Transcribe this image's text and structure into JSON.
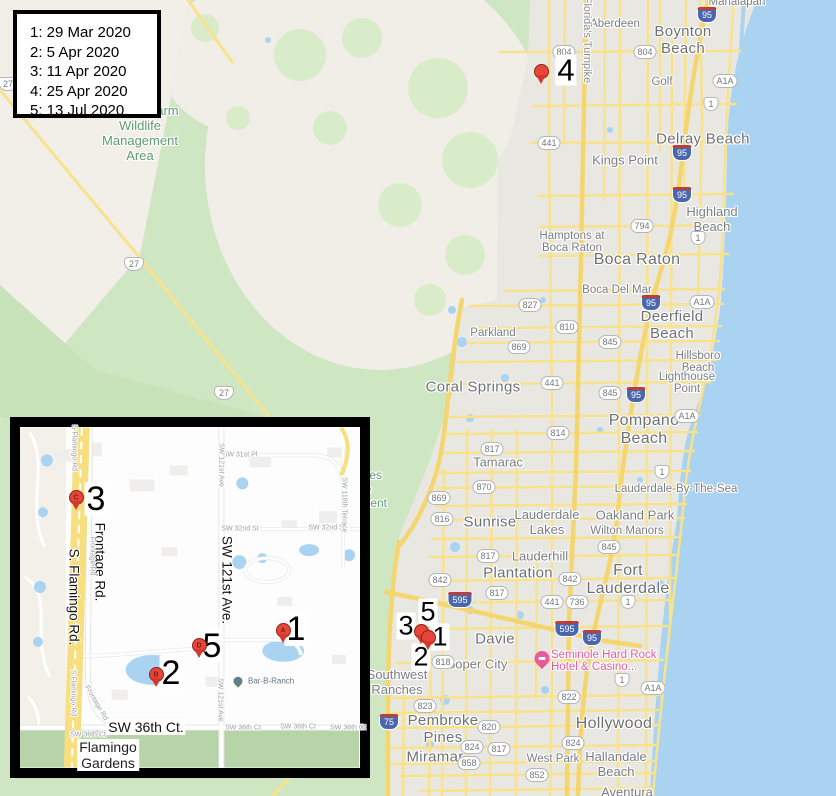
{
  "legend": {
    "entries": [
      "1: 29 Mar 2020",
      "2: 5 Apr 2020",
      "3: 11 Apr 2020",
      "4: 25 Apr 2020",
      "5: 13 Jul 2020"
    ]
  },
  "colors": {
    "water": "#a9d3f1",
    "urban": "#e9e7e2",
    "farmland": "#f1efe8",
    "conservation_green": "#cfe6c2",
    "road_yellow": "#f8e28c",
    "marker_red": "#e6453a",
    "poi_pink": "#e85a9e",
    "label_green": "#5e9b6e"
  },
  "main_map": {
    "labels": [
      {
        "t": "Boynton\nBeach",
        "x": 683,
        "y": 40,
        "c": "city"
      },
      {
        "t": "Delray Beach",
        "x": 703,
        "y": 139,
        "c": "city"
      },
      {
        "t": "Boca Raton",
        "x": 637,
        "y": 260,
        "c": "city",
        "s": 16
      },
      {
        "t": "Deerfield\nBeach",
        "x": 672,
        "y": 325,
        "c": "city"
      },
      {
        "t": "Pompano\nBeach",
        "x": 644,
        "y": 430,
        "c": "city",
        "s": 16
      },
      {
        "t": "Fort\nLauderdale",
        "x": 628,
        "y": 580,
        "c": "city",
        "s": 16
      },
      {
        "t": "Hollywood",
        "x": 614,
        "y": 724,
        "c": "city",
        "s": 16
      },
      {
        "t": "Coral Springs",
        "x": 473,
        "y": 387,
        "c": "city"
      },
      {
        "t": "Sunrise",
        "x": 490,
        "y": 522,
        "c": "city"
      },
      {
        "t": "Plantation",
        "x": 518,
        "y": 573,
        "c": "city"
      },
      {
        "t": "Davie",
        "x": 495,
        "y": 639,
        "c": "city"
      },
      {
        "t": "Tamarac",
        "x": 498,
        "y": 462,
        "c": "town",
        "s": 13
      },
      {
        "t": "Miramar",
        "x": 435,
        "y": 757,
        "c": "city"
      },
      {
        "t": "Pembroke\nPines",
        "x": 443,
        "y": 729,
        "c": "city"
      },
      {
        "t": "Hallandale\nBeach",
        "x": 616,
        "y": 764,
        "c": "town",
        "s": 13
      },
      {
        "t": "Aberdeen",
        "x": 615,
        "y": 24,
        "c": "town"
      },
      {
        "t": "Kings Point",
        "x": 625,
        "y": 160,
        "c": "town",
        "s": 13
      },
      {
        "t": "Golf",
        "x": 662,
        "y": 82,
        "c": "town"
      },
      {
        "t": "Highland\nBeach",
        "x": 712,
        "y": 219,
        "c": "town",
        "s": 13
      },
      {
        "t": "Hamptons at\nBoca Raton",
        "x": 572,
        "y": 242,
        "c": "town"
      },
      {
        "t": "Boca Del Mar",
        "x": 617,
        "y": 290,
        "c": "town"
      },
      {
        "t": "Parkland",
        "x": 493,
        "y": 333,
        "c": "town"
      },
      {
        "t": "Hillsboro\nBeach",
        "x": 698,
        "y": 362,
        "c": "town"
      },
      {
        "t": "Lighthouse\nPoint",
        "x": 687,
        "y": 383,
        "c": "town"
      },
      {
        "t": "Lauderdale-By-The-Sea",
        "x": 676,
        "y": 489,
        "c": "town"
      },
      {
        "t": "Oakland Park",
        "x": 635,
        "y": 515,
        "c": "town",
        "s": 13
      },
      {
        "t": "Wilton Manors",
        "x": 627,
        "y": 531,
        "c": "town"
      },
      {
        "t": "Lauderdale\nLakes",
        "x": 547,
        "y": 522,
        "c": "town",
        "s": 13
      },
      {
        "t": "Lauderhill",
        "x": 540,
        "y": 556,
        "c": "town",
        "s": 13
      },
      {
        "t": "Cooper City",
        "x": 473,
        "y": 664,
        "c": "town",
        "s": 13
      },
      {
        "t": "Southwest\nRanches",
        "x": 397,
        "y": 682,
        "c": "town",
        "s": 13
      },
      {
        "t": "West Park",
        "x": 553,
        "y": 759,
        "c": "town"
      },
      {
        "t": "Aventura",
        "x": 627,
        "y": 792,
        "c": "town",
        "s": 13
      },
      {
        "t": "Manalapan",
        "x": 737,
        "y": 2,
        "c": "town"
      },
      {
        "t": "Browns Farm\nWildlife\nManagement\nArea",
        "x": 140,
        "y": 133,
        "c": "green",
        "s": 13
      },
      {
        "t": "Everglades\nWildlife\nManagement\nArea...",
        "x": 352,
        "y": 496,
        "c": "green"
      },
      {
        "t": "Florida's Turnpike",
        "x": 587,
        "y": 40,
        "c": "vroad",
        "rot": 90
      }
    ],
    "shields": [
      {
        "k": "i",
        "t": "95",
        "x": 707,
        "y": 15
      },
      {
        "k": "s",
        "t": "804",
        "x": 564,
        "y": 52
      },
      {
        "k": "s",
        "t": "804",
        "x": 645,
        "y": 52
      },
      {
        "k": "s",
        "t": "A1A",
        "x": 725,
        "y": 81
      },
      {
        "k": "u",
        "t": "1",
        "x": 711,
        "y": 104
      },
      {
        "k": "s",
        "t": "441",
        "x": 549,
        "y": 143
      },
      {
        "k": "i",
        "t": "95",
        "x": 682,
        "y": 153
      },
      {
        "k": "i",
        "t": "95",
        "x": 682,
        "y": 195
      },
      {
        "k": "s",
        "t": "794",
        "x": 642,
        "y": 226
      },
      {
        "k": "u",
        "t": "1",
        "x": 698,
        "y": 238
      },
      {
        "k": "u",
        "t": "27",
        "x": 8,
        "y": 84
      },
      {
        "k": "u",
        "t": "27",
        "x": 134,
        "y": 264
      },
      {
        "k": "s",
        "t": "A1A",
        "x": 702,
        "y": 302
      },
      {
        "k": "s",
        "t": "827",
        "x": 530,
        "y": 305
      },
      {
        "k": "i",
        "t": "95",
        "x": 651,
        "y": 303
      },
      {
        "k": "s",
        "t": "810",
        "x": 567,
        "y": 327
      },
      {
        "k": "s",
        "t": "845",
        "x": 610,
        "y": 342
      },
      {
        "k": "s",
        "t": "869",
        "x": 519,
        "y": 347
      },
      {
        "k": "s",
        "t": "441",
        "x": 552,
        "y": 383
      },
      {
        "k": "s",
        "t": "845",
        "x": 610,
        "y": 393
      },
      {
        "k": "i",
        "t": "95",
        "x": 636,
        "y": 395
      },
      {
        "k": "u",
        "t": "27",
        "x": 224,
        "y": 393
      },
      {
        "k": "s",
        "t": "A1A",
        "x": 687,
        "y": 416
      },
      {
        "k": "s",
        "t": "814",
        "x": 558,
        "y": 433
      },
      {
        "k": "s",
        "t": "817",
        "x": 492,
        "y": 449
      },
      {
        "k": "u",
        "t": "1",
        "x": 662,
        "y": 472
      },
      {
        "k": "s",
        "t": "870",
        "x": 484,
        "y": 487
      },
      {
        "k": "s",
        "t": "869",
        "x": 439,
        "y": 498
      },
      {
        "k": "s",
        "t": "816",
        "x": 442,
        "y": 519
      },
      {
        "k": "s",
        "t": "845",
        "x": 609,
        "y": 547
      },
      {
        "k": "s",
        "t": "817",
        "x": 488,
        "y": 556
      },
      {
        "k": "s",
        "t": "842",
        "x": 440,
        "y": 580
      },
      {
        "k": "s",
        "t": "842",
        "x": 570,
        "y": 579
      },
      {
        "k": "s",
        "t": "817",
        "x": 497,
        "y": 593
      },
      {
        "k": "i",
        "t": "595",
        "x": 460,
        "y": 600
      },
      {
        "k": "s",
        "t": "441",
        "x": 552,
        "y": 602
      },
      {
        "k": "s",
        "t": "736",
        "x": 577,
        "y": 602
      },
      {
        "k": "u",
        "t": "1",
        "x": 628,
        "y": 602
      },
      {
        "k": "i",
        "t": "595",
        "x": 567,
        "y": 629
      },
      {
        "k": "i",
        "t": "95",
        "x": 592,
        "y": 638
      },
      {
        "k": "s",
        "t": "818",
        "x": 443,
        "y": 662
      },
      {
        "k": "u",
        "t": "1",
        "x": 622,
        "y": 680
      },
      {
        "k": "s",
        "t": "A1A",
        "x": 653,
        "y": 688
      },
      {
        "k": "s",
        "t": "822",
        "x": 569,
        "y": 697
      },
      {
        "k": "s",
        "t": "823",
        "x": 425,
        "y": 706
      },
      {
        "k": "i",
        "t": "75",
        "x": 389,
        "y": 722
      },
      {
        "k": "s",
        "t": "820",
        "x": 489,
        "y": 727
      },
      {
        "k": "s",
        "t": "824",
        "x": 472,
        "y": 747
      },
      {
        "k": "s",
        "t": "824",
        "x": 573,
        "y": 743
      },
      {
        "k": "s",
        "t": "817",
        "x": 499,
        "y": 749
      },
      {
        "k": "s",
        "t": "858",
        "x": 469,
        "y": 763
      },
      {
        "k": "s",
        "t": "852",
        "x": 537,
        "y": 775
      }
    ],
    "markers": {
      "numbers": [
        {
          "t": "4",
          "x": 566,
          "y": 70,
          "fs": 31
        },
        {
          "t": "3",
          "x": 406,
          "y": 626,
          "fs": 27
        },
        {
          "t": "5",
          "x": 428,
          "y": 612,
          "fs": 27
        },
        {
          "t": "1",
          "x": 440,
          "y": 637,
          "fs": 27
        },
        {
          "t": "2",
          "x": 421,
          "y": 657,
          "fs": 27
        }
      ],
      "pins": [
        {
          "x": 541,
          "y": 85
        },
        {
          "x": 421,
          "y": 645
        },
        {
          "x": 428,
          "y": 651
        }
      ]
    },
    "poi": {
      "line1": "Seminole Hard Rock",
      "line2": "Hotel & Casino...",
      "x": 551,
      "y": 661,
      "icon_x": 542,
      "icon_y": 660
    }
  },
  "inset": {
    "labels": [
      {
        "t": "Frontage Rd.",
        "x": 100,
        "y": 562,
        "c": "iroadbig",
        "rot": 90
      },
      {
        "t": "S. Flamingo Rd.",
        "x": 74,
        "y": 597,
        "c": "iroadbig",
        "rot": 90
      },
      {
        "t": "SW 121st Ave.",
        "x": 227,
        "y": 580,
        "c": "iroadbig",
        "rot": 90
      },
      {
        "t": "SW 36th Ct.",
        "x": 146,
        "y": 727,
        "c": "iroadbig2"
      },
      {
        "t": "Flamingo\nGardens",
        "x": 108,
        "y": 755,
        "c": "iplace"
      },
      {
        "t": "SW 31st Pl",
        "x": 240,
        "y": 455,
        "c": "ismall"
      },
      {
        "t": "SW 32nd St",
        "x": 240,
        "y": 529,
        "c": "ismall"
      },
      {
        "t": "SW 32nd St",
        "x": 327,
        "y": 528,
        "c": "ismall"
      },
      {
        "t": "SW 36th Ct",
        "x": 88,
        "y": 735,
        "c": "ismall"
      },
      {
        "t": "SW 36th Ct",
        "x": 243,
        "y": 728,
        "c": "ismall"
      },
      {
        "t": "SW 36th Ct",
        "x": 298,
        "y": 727,
        "c": "ismall"
      },
      {
        "t": "SW 36th Ct",
        "x": 348,
        "y": 728,
        "c": "ismall"
      },
      {
        "t": "SW 121st Ave",
        "x": 221,
        "y": 465,
        "c": "ismall",
        "rot": 90
      },
      {
        "t": "SW 121st Ave",
        "x": 220,
        "y": 700,
        "c": "ismall",
        "rot": 90
      },
      {
        "t": "SW 118th Terrace",
        "x": 344,
        "y": 505,
        "c": "ismall",
        "rot": 90
      },
      {
        "t": "Frontage Rd",
        "x": 92,
        "y": 556,
        "c": "ismall",
        "rot": 90
      },
      {
        "t": "Frontage Rd",
        "x": 96,
        "y": 703,
        "c": "ismall",
        "rot": 60
      },
      {
        "t": "S Flamingo Rd",
        "x": 73,
        "y": 693,
        "c": "ismall",
        "rot": 90
      },
      {
        "t": "S Flamingo Rd",
        "x": 74,
        "y": 448,
        "c": "ismall",
        "rot": 90
      }
    ],
    "numbers": [
      {
        "t": "3",
        "x": 96,
        "y": 499,
        "fs": 34
      },
      {
        "t": "5",
        "x": 212,
        "y": 646,
        "fs": 34
      },
      {
        "t": "1",
        "x": 296,
        "y": 629,
        "fs": 34
      },
      {
        "t": "2",
        "x": 171,
        "y": 673,
        "fs": 34
      }
    ],
    "pins": [
      {
        "x": 76,
        "y": 511,
        "l": "C"
      },
      {
        "x": 199,
        "y": 659,
        "l": "D"
      },
      {
        "x": 283,
        "y": 644,
        "l": "A"
      },
      {
        "x": 156,
        "y": 688,
        "l": "B"
      }
    ],
    "poi": {
      "name": "Bar-B-Ranch",
      "x": 248,
      "y": 681,
      "icon_x": 238,
      "icon_y": 683
    }
  }
}
